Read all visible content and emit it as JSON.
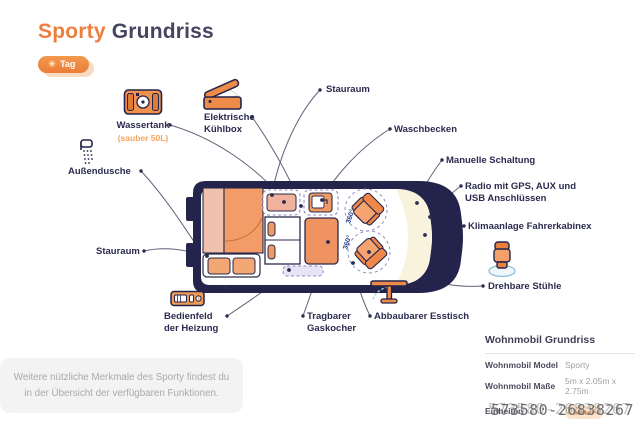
{
  "header": {
    "title_accent": "Sporty",
    "title_rest": "Grundriss",
    "mode_badge": {
      "icon": "sun-icon",
      "label": "Tag"
    }
  },
  "diagram": {
    "rotation_label": "360°",
    "callouts": [
      {
        "id": "wassertank",
        "label": "Wassertank",
        "sublabel": "(sauber 50L)",
        "icon": "water-tank-icon"
      },
      {
        "id": "kuehlbox",
        "label": "Elektrische Kühlbox",
        "icon": "cooler-icon"
      },
      {
        "id": "stauraum-oben",
        "label": "Stauraum"
      },
      {
        "id": "waschbecken",
        "label": "Waschbecken"
      },
      {
        "id": "schaltung",
        "label": "Manuelle Schaltung"
      },
      {
        "id": "radio",
        "label": "Radio mit GPS, AUX und USB Anschlüssen"
      },
      {
        "id": "klimaanlage",
        "label": "Klimaanlage Fahrerkabinex"
      },
      {
        "id": "stuehle",
        "label": "Drehbare Stühle",
        "icon": "swivel-chair-icon"
      },
      {
        "id": "esstisch",
        "label": "Abbaubarer Esstisch",
        "icon": "folding-table-icon"
      },
      {
        "id": "gaskocher",
        "label": "Tragbarer Gaskocher"
      },
      {
        "id": "bedienfeld",
        "label": "Bedienfeld der Heizung",
        "icon": "heater-control-icon"
      },
      {
        "id": "stauraum-links",
        "label": "Stauraum"
      },
      {
        "id": "aussendusche",
        "label": "Außendusche",
        "icon": "shower-icon"
      }
    ]
  },
  "footer_note": "Weitere nützliche Merkmale des Sporty findest du in der Übersicht der verfügbaren Funktionen.",
  "info_panel": {
    "heading": "Wohnmobil Grundriss",
    "rows": [
      {
        "label": "Wohnmobil Model",
        "value": "Sporty"
      },
      {
        "label": "Wohnmobil Maße",
        "value": "5m x 2.05m x 2.75m"
      },
      {
        "label": "Einheiten",
        "value": "Meter"
      }
    ]
  },
  "watermark": "573580-26838267",
  "colors": {
    "accent": "#ee7e3e",
    "navy": "#23234b",
    "bed_orange": "#f49c67",
    "cream": "#f9f3de"
  }
}
